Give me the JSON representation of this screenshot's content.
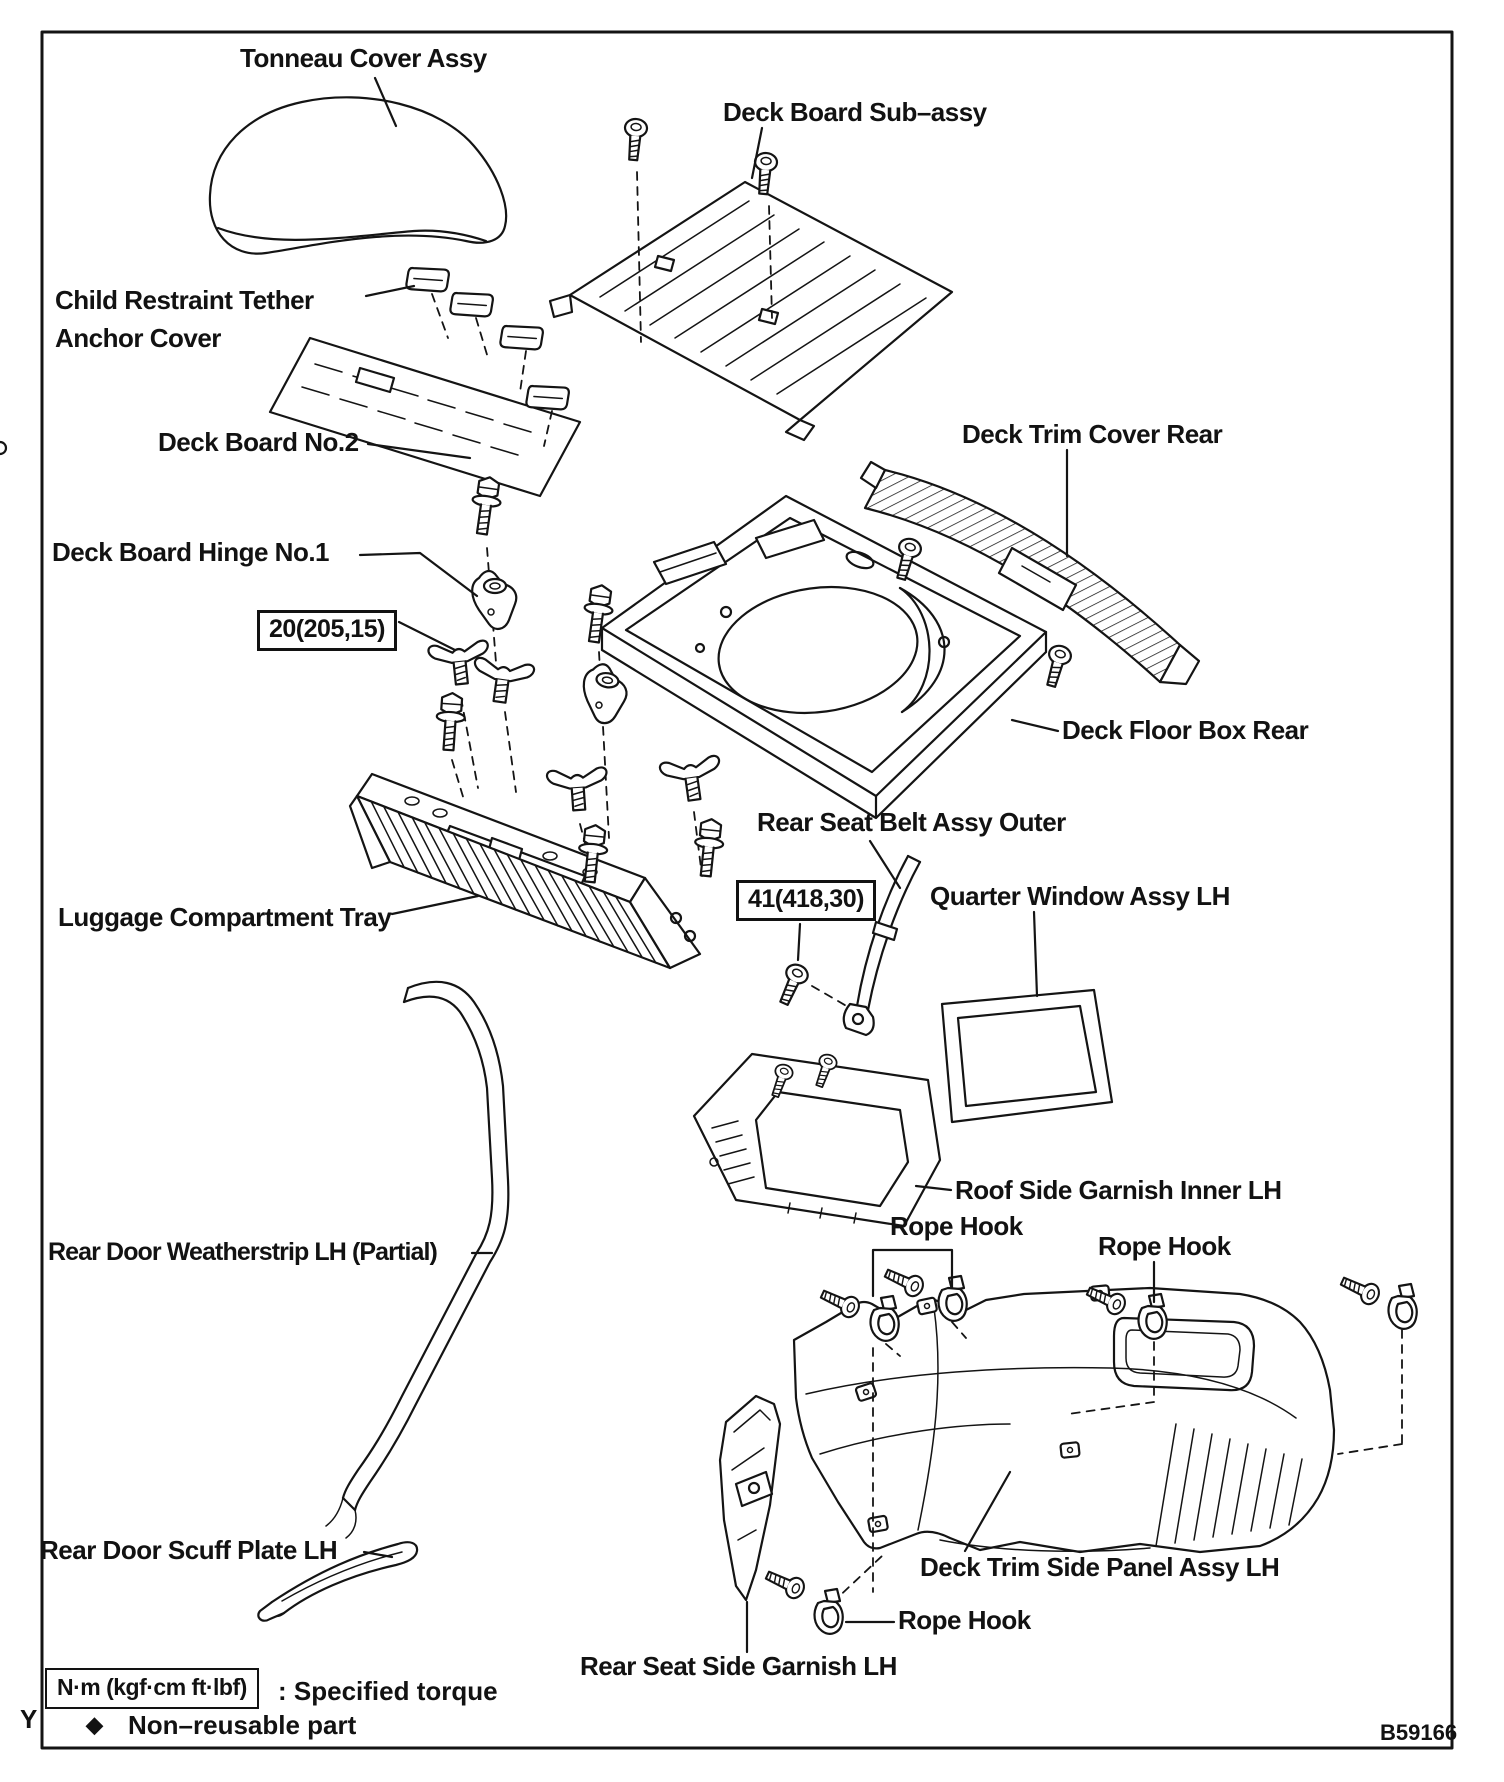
{
  "diagram": {
    "part_labels": {
      "tonneau_cover": "Tonneau Cover Assy",
      "deck_board_sub_assy": "Deck Board Sub–assy",
      "child_restraint_tether_line1": "Child Restraint Tether",
      "child_restraint_tether_line2": "Anchor Cover",
      "deck_board_no2": "Deck Board No.2",
      "deck_trim_cover_rear": "Deck Trim Cover Rear",
      "deck_board_hinge_no1": "Deck Board Hinge No.1",
      "deck_floor_box_rear": "Deck Floor Box Rear",
      "rear_seat_belt_assy_outer": "Rear Seat Belt Assy Outer",
      "quarter_window_assy_lh": "Quarter Window Assy LH",
      "luggage_compartment_tray": "Luggage Compartment Tray",
      "roof_side_garnish_inner_lh": "Roof Side Garnish Inner LH",
      "rope_hook_top": "Rope Hook",
      "rope_hook_right": "Rope Hook",
      "rope_hook_bottom": "Rope Hook",
      "rear_door_weatherstrip_lh": "Rear Door Weatherstrip LH (Partial)",
      "deck_trim_side_panel_assy_lh": "Deck Trim Side Panel Assy LH",
      "rear_door_scuff_plate_lh": "Rear Door Scuff Plate LH",
      "rear_seat_side_garnish_lh": "Rear Seat Side Garnish LH"
    },
    "torque_specs": {
      "deck_board_hinge_bolt": "20(205,15)",
      "seat_belt_anchor_bolt": "41(418,30)"
    },
    "legend": {
      "torque_unit_box": "N·m (kgf·cm ft·lbf)",
      "torque_meaning": ": Specified torque",
      "non_reusable_symbol": "◆",
      "non_reusable_text": "Non–reusable part"
    },
    "footer": {
      "page_marker": "Y",
      "figure_code": "B59166"
    }
  }
}
